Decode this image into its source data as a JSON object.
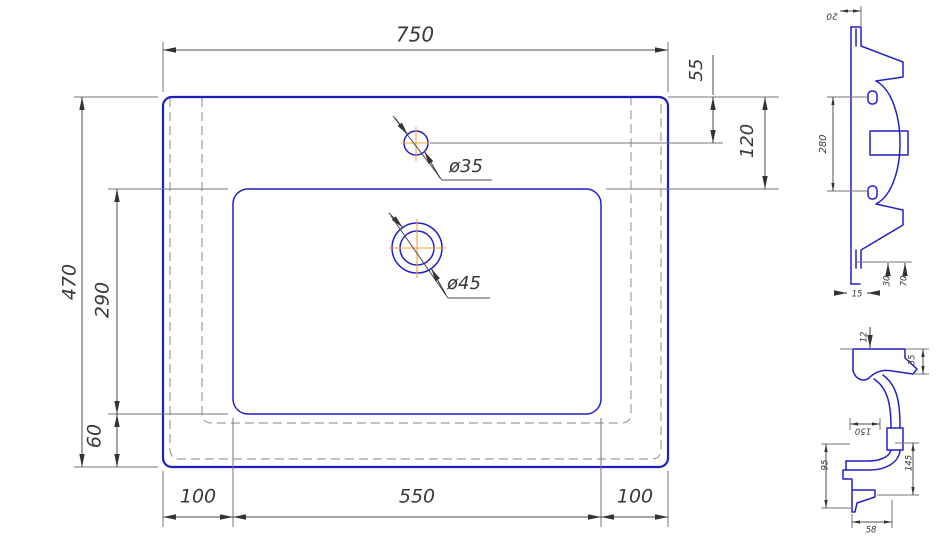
{
  "drawing": {
    "type": "technical-drawing-washbasin",
    "colors": {
      "part_line_blue": "#2121c8",
      "dimension_line": "#4d4d4d",
      "extension_line": "#767676",
      "hidden_dashed": "#9e9e9e",
      "center_mark_orange": "#eda33c",
      "text": "#383838",
      "background": "#ffffff"
    },
    "plan": {
      "dim_width": "750",
      "dim_faucet_from_top": "55",
      "dim_basin_from_top": "120",
      "dim_height": "470",
      "dim_basin_length": "290",
      "dim_front_gap": "60",
      "dim_left_margin": "100",
      "dim_basin_width": "550",
      "dim_right_margin": "100",
      "label_faucet_hole": "ø35",
      "label_drain_hole": "ø45"
    },
    "side": {
      "dim_rim": "20",
      "dim_bowl_span": "280",
      "dim_a": "30",
      "dim_b": "70",
      "dim_lip": "15"
    },
    "section": {
      "dim_top": "12",
      "dim_edge": "35",
      "dim_width": "150",
      "dim_left": "95",
      "dim_right": "145",
      "dim_bottom": "58"
    }
  }
}
